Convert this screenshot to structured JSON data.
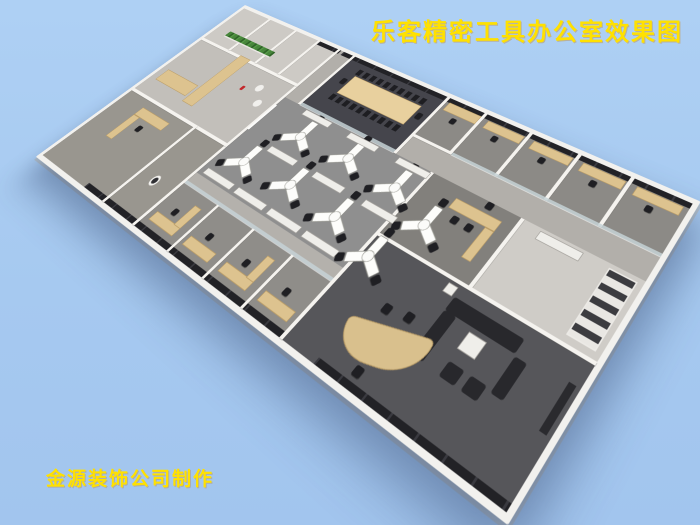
{
  "title": {
    "text": "乐客精密工具办公室效果图",
    "color": "#FFE100"
  },
  "watermark": {
    "text": "金源装饰公司制作",
    "color": "#FFE100"
  },
  "background_color": "#A8CBF2",
  "rendering": {
    "type": "3d-isometric-office-floorplan",
    "palette": {
      "slab_wall": "#F2F1EE",
      "open_office_floor": "#8F8F8F",
      "conference_floor": "#45454C",
      "executive_floor": "#56565A",
      "corridor_floor": "#B2AFAA",
      "wood_furniture": "#DDC38F",
      "window_glass": "#26262A",
      "office_chair": "#1F1F23",
      "plants": "#47863B",
      "fire_extinguisher": "#C3272B"
    },
    "depicted_rooms": [
      "storage-rooms",
      "plant-divider-area",
      "break-nook",
      "left-office",
      "washroom",
      "conference-room",
      "kitchenette",
      "private-offices-back-row",
      "open-office-area",
      "front-office-row",
      "executive-office",
      "shelving-room",
      "executive-lounge-reception"
    ],
    "workstation_clusters": 8,
    "conference_chairs": 16
  }
}
